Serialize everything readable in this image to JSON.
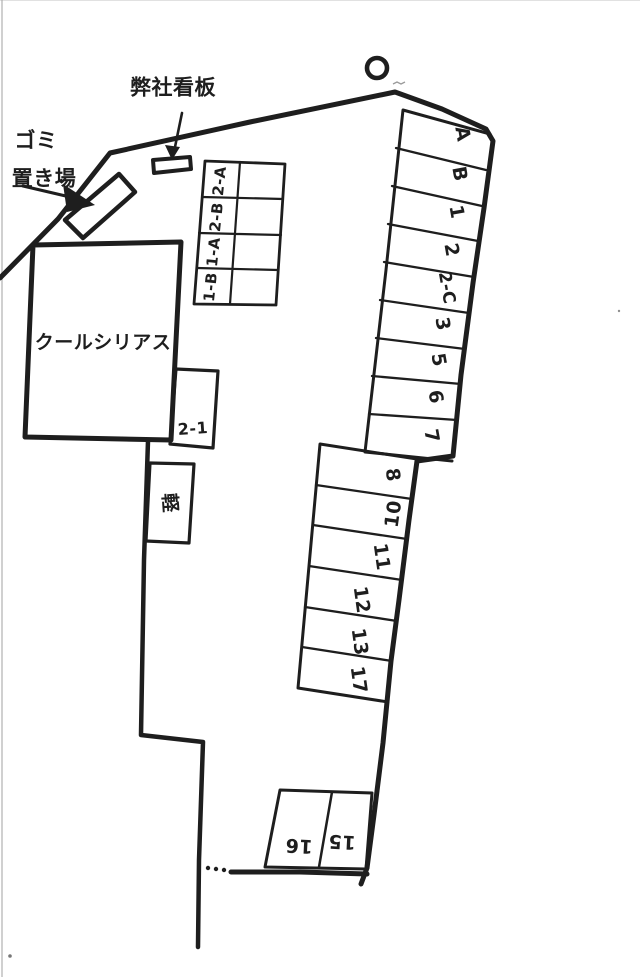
{
  "colors": {
    "ink": "#1e1e1e",
    "paper": "#ffffff",
    "scan_edge": "#a9a9a9"
  },
  "annotations": {
    "company_sign": "弊社看板",
    "garbage_area_line1": "ゴミ",
    "garbage_area_line2": "置き場",
    "building": "クールシリアス"
  },
  "spaces": {
    "right_strip": [
      "A",
      "B",
      "1",
      "2",
      "2-C",
      "3",
      "5",
      "6",
      "7"
    ],
    "middle_strip": [
      "8",
      "10",
      "11",
      "12",
      "13",
      "17"
    ],
    "top_grid": [
      "2-A",
      "2-B",
      "1-A",
      "1-B"
    ],
    "bottom_pair": [
      "16",
      "15"
    ],
    "kei": "軽",
    "unit_2_1": "2-1"
  }
}
